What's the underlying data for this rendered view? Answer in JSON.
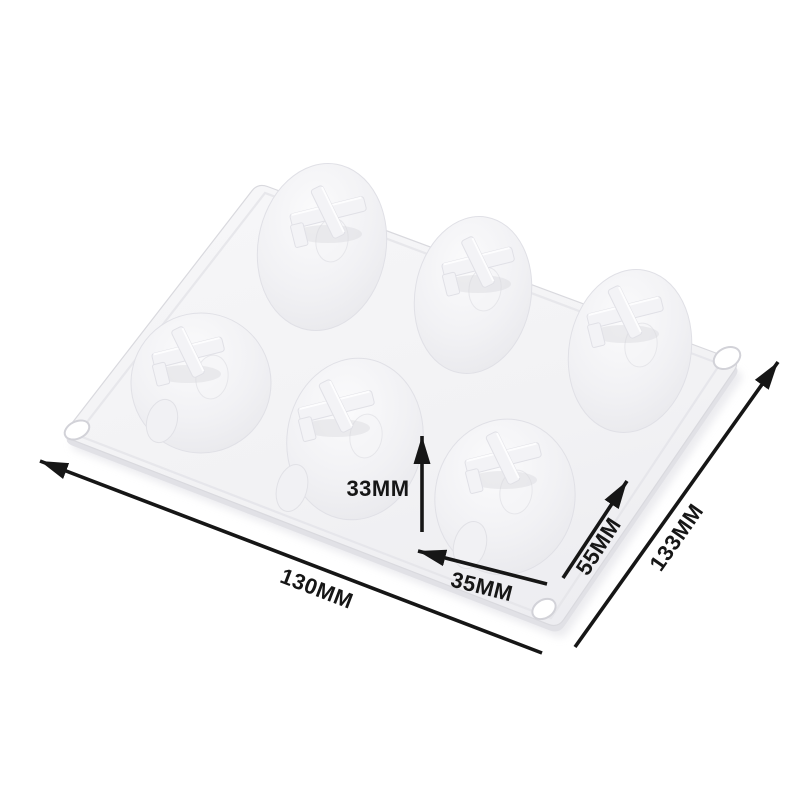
{
  "scene": {
    "description": "White 6-cavity silicone dessert mold shown at an angle on a plain white background with black dimension arrows",
    "background_color": "#ffffff"
  },
  "product": {
    "name": "silicone mold tray",
    "cavity_count": 6,
    "cavity_style": "dome with cross-shaped top fin",
    "corner_holes_visible": 3,
    "material_color": "#f2f2f5"
  },
  "dimensions": {
    "overall_length": {
      "label": "130MM"
    },
    "overall_depth": {
      "label": "133MM"
    },
    "cavity_height": {
      "label": "33MM"
    },
    "cavity_width": {
      "label": "35MM"
    },
    "cavity_length": {
      "label": "55MM"
    }
  },
  "colors": {
    "annotation_text": "#161616",
    "arrow": "#161616",
    "mold_surface": "#f2f2f4",
    "mold_shadow": "#e3e3e8",
    "mold_highlight": "#fafafb"
  }
}
